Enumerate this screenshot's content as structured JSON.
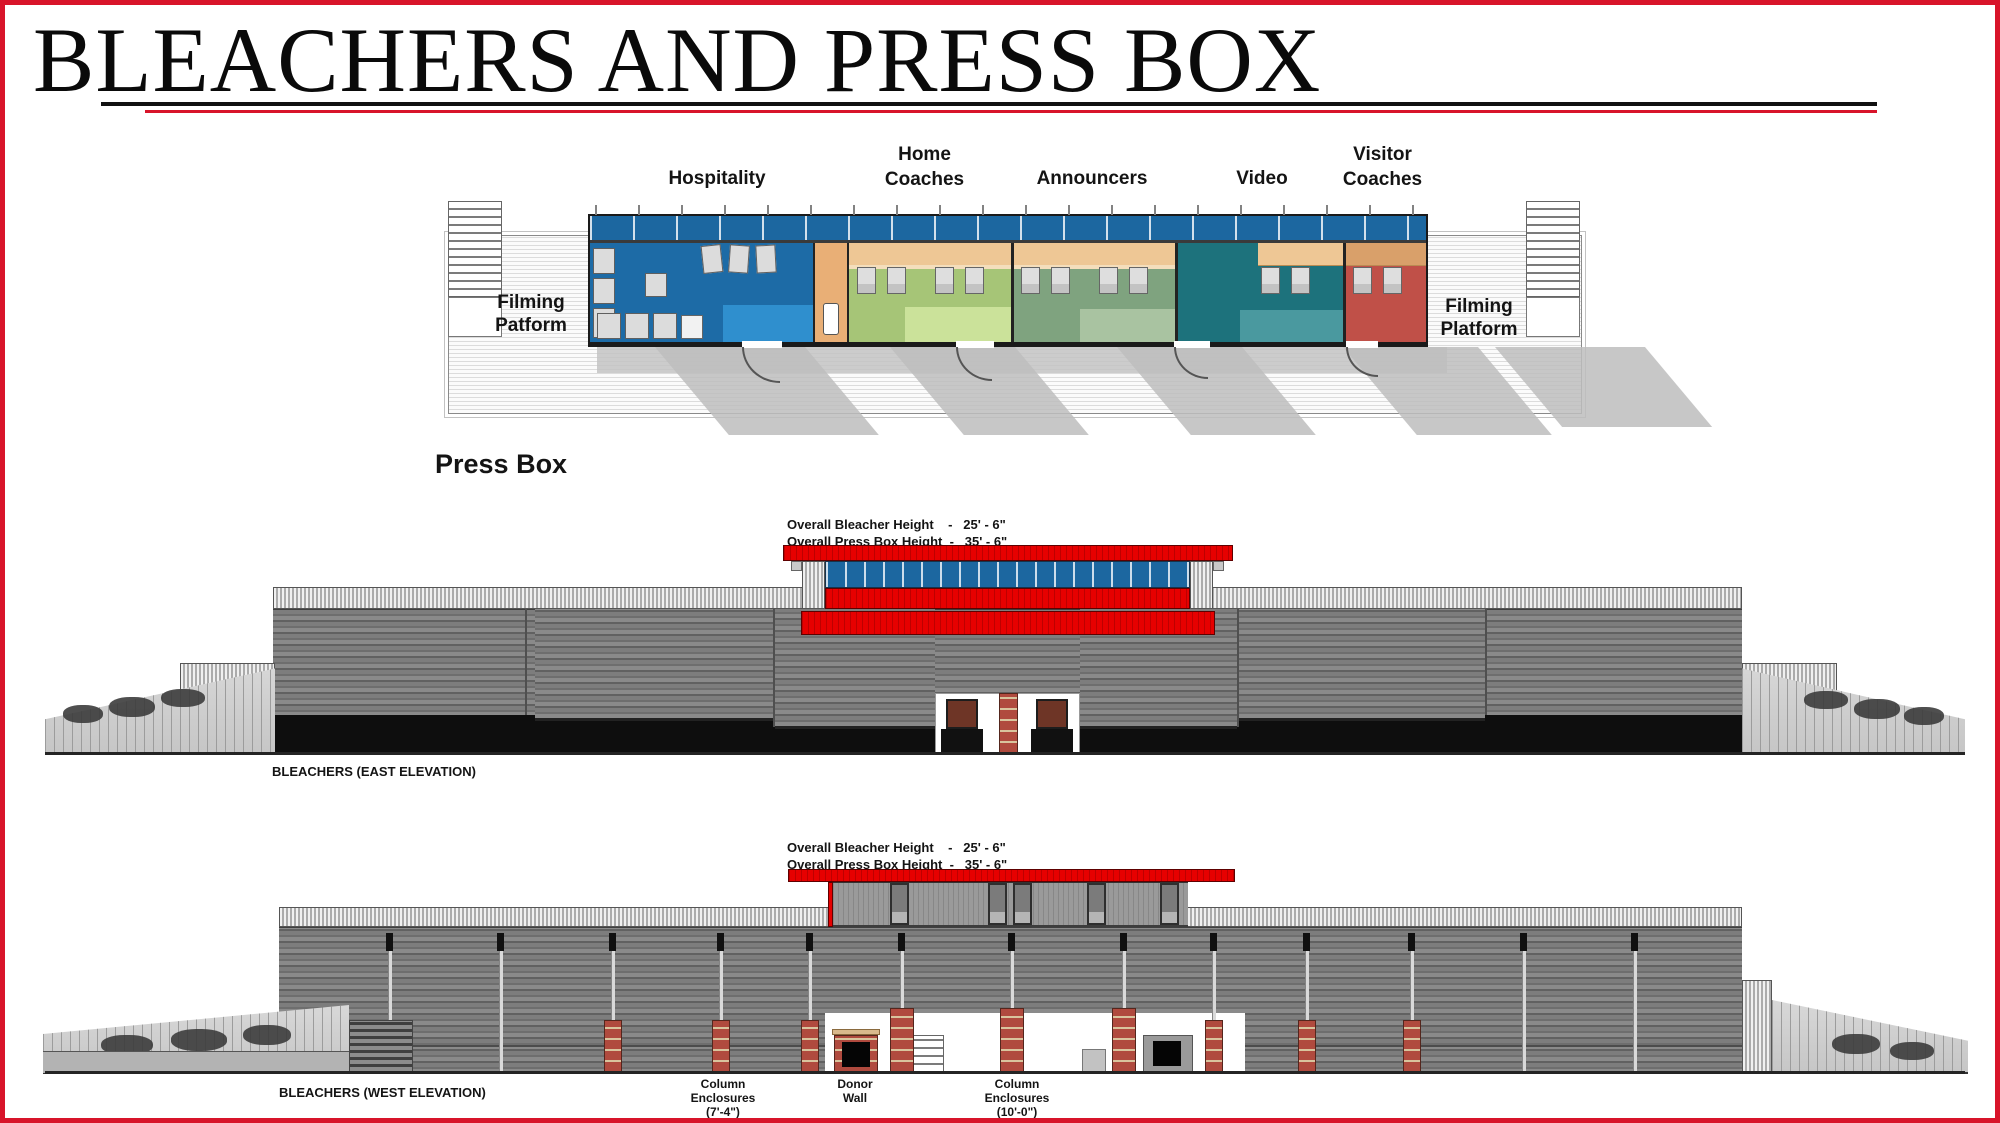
{
  "title": "BLEACHERS AND PRESS BOX",
  "plan": {
    "caption": "Press Box",
    "room_labels": [
      "Hospitality",
      "Home Coaches",
      "Announcers",
      "Video",
      "Visitor Coaches"
    ],
    "platform_left": {
      "line1": "Filming",
      "line2": "Patform"
    },
    "platform_right": {
      "line1": "Filming",
      "line2": "Platform"
    }
  },
  "east": {
    "dim1": "Overall Bleacher Height    -   25' - 6\"",
    "dim2": "Overall Press Box Height  -   35' - 6\"",
    "label": "BLEACHERS (EAST ELEVATION)"
  },
  "west": {
    "dim1": "Overall Bleacher Height    -   25' - 6\"",
    "dim2": "Overall Press Box Height  -   35' - 6\"",
    "label": "BLEACHERS (WEST ELEVATION)",
    "callouts": [
      {
        "l1": "Column",
        "l2": "Enclosures",
        "l3": "(7'-4\")"
      },
      {
        "l1": "Donor",
        "l2": "Wall",
        "l3": ""
      },
      {
        "l1": "Column",
        "l2": "Enclosures",
        "l3": "(10'-0\")"
      }
    ]
  },
  "colors": {
    "page-red": "#d8142a",
    "roof-red": "#e60000",
    "win-blue": "#1c67a0",
    "room-blue": "#1d6ba6",
    "room-blue-light": "#2f8fce",
    "tan": "#e9af76",
    "tan-light": "#eec795",
    "room-green": "#a6c577",
    "room-green-light": "#cbe29a",
    "room-sage": "#7fa37f",
    "room-sage-light": "#a9c3a1",
    "room-teal": "#1d727c",
    "room-teal-light": "#4a999f",
    "room-red": "#c05048",
    "brick": "#b04a3e",
    "wall-gray": "#8a8a8a",
    "wall-dark": "#6e6e6e",
    "black-base": "#0e0e0e"
  }
}
